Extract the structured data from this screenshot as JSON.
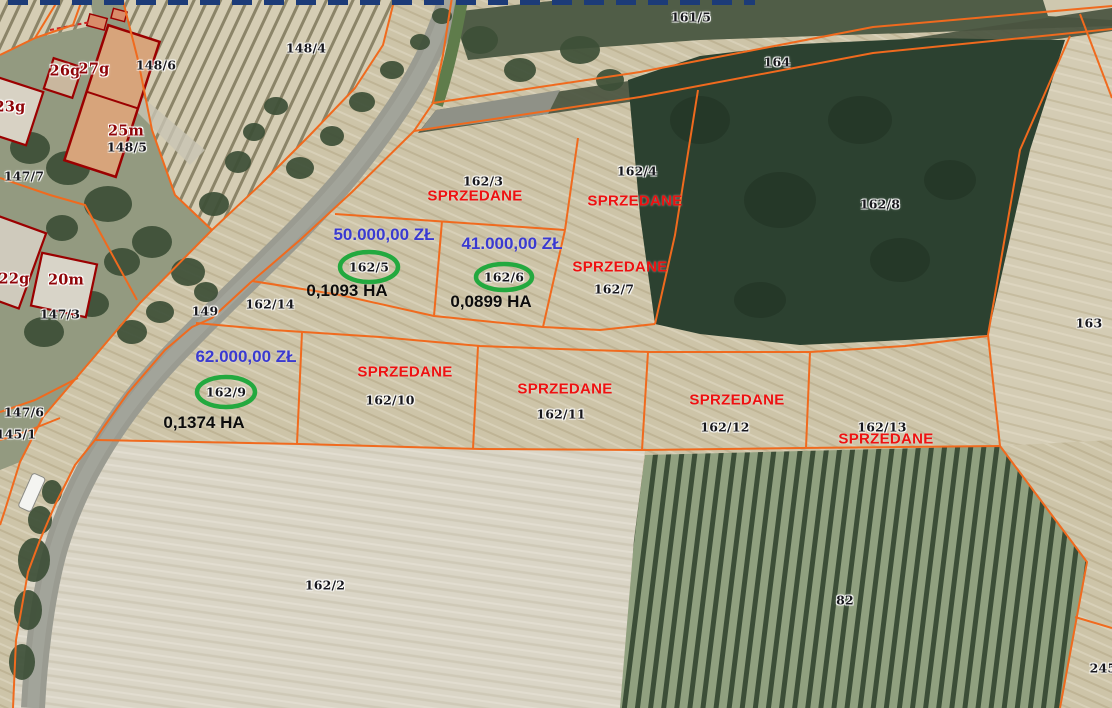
{
  "map": {
    "texts": {
      "sold": "SPRZEDANE"
    },
    "for_sale": {
      "plot_162_5": {
        "number": "162/5",
        "price": "50.000,00 ZŁ",
        "area": "0,1093 HA"
      },
      "plot_162_6": {
        "number": "162/6",
        "price": "41.000,00 ZŁ",
        "area": "0,0899 HA"
      },
      "plot_162_9": {
        "number": "162/9",
        "price": "62.000,00 ZŁ",
        "area": "0,1374 HA"
      }
    },
    "sold_parcels": [
      "162/3",
      "162/4",
      "162/7",
      "162/10",
      "162/11",
      "162/12",
      "162/13"
    ],
    "parcel_labels": {
      "p148_4": "148/4",
      "p148_6": "148/6",
      "p148_5": "148/5",
      "p147_7": "147/7",
      "p147_3": "147/3",
      "p147_6": "147/6",
      "p145_1": "145/1",
      "p149": "149",
      "p161_5": "161/5",
      "p164": "164",
      "p162_3": "162/3",
      "p162_4": "162/4",
      "p162_7": "162/7",
      "p162_8": "162/8",
      "p162_14": "162/14",
      "p163": "163",
      "p162_10": "162/10",
      "p162_11": "162/11",
      "p162_12": "162/12",
      "p162_13": "162/13",
      "p162_2": "162/2",
      "p82": "82",
      "p245": "245"
    },
    "building_labels": {
      "b26g": "26g",
      "b27g": "27g",
      "b23g": "23g",
      "b25m": "25m",
      "b22g": "22g",
      "b20m": "20m"
    },
    "colors": {
      "boundary_line": "#f06a1e",
      "sold_text": "#ee1111",
      "price_text": "#3a3ad0",
      "area_text": "#0c0c0c",
      "highlight_ellipse": "#23a93f",
      "building_outline": "#9b0000"
    }
  }
}
